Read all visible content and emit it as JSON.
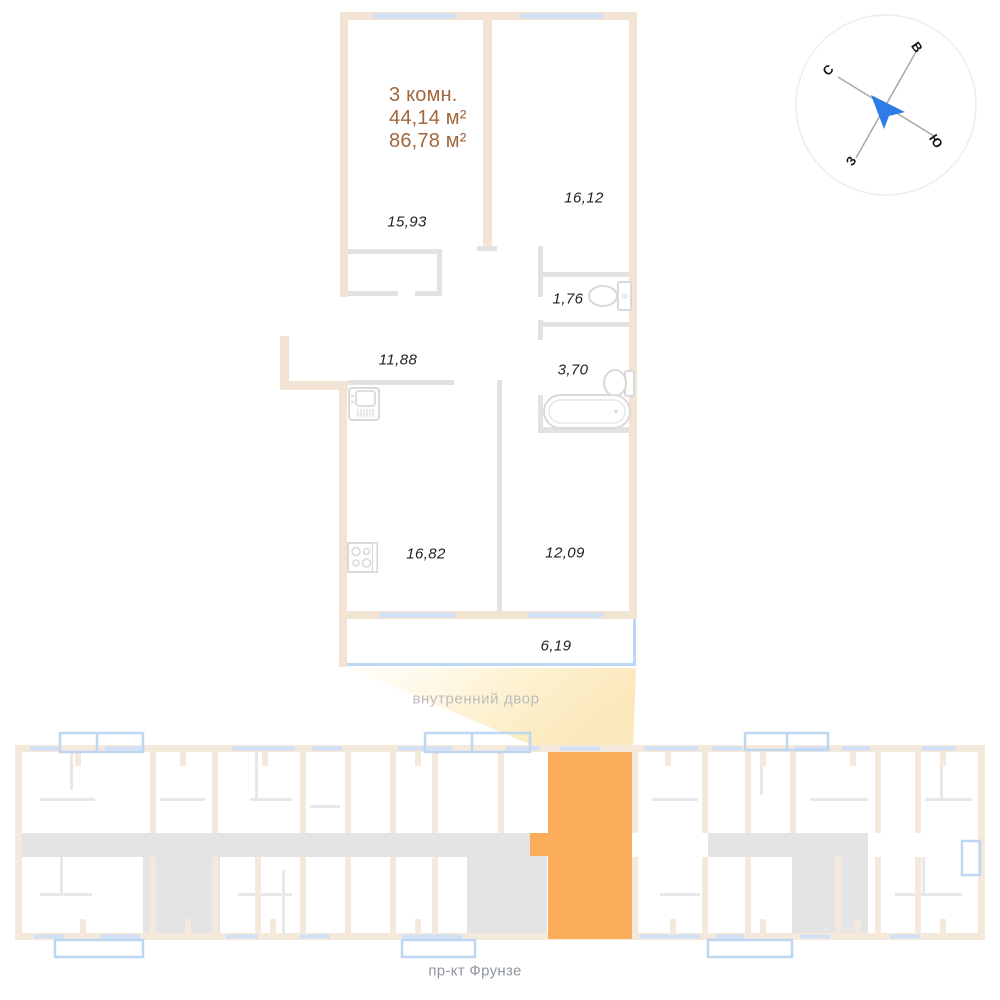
{
  "unit_card": {
    "rooms_label": "3 комн.",
    "area_living": "44,14 м²",
    "area_total": "86,78 м²",
    "accent_color": "#a2663c"
  },
  "plan": {
    "room_areas": [
      {
        "id": "living-room-1",
        "area": "15,93"
      },
      {
        "id": "living-room-2",
        "area": "16,12"
      },
      {
        "id": "wc",
        "area": "1,76"
      },
      {
        "id": "bathroom",
        "area": "3,70"
      },
      {
        "id": "hallway",
        "area": "11,88"
      },
      {
        "id": "kitchen",
        "area": "16,82"
      },
      {
        "id": "living-room-3",
        "area": "12,09"
      },
      {
        "id": "balcony",
        "area": "6,19"
      }
    ],
    "fixtures": [
      "toilet-icon",
      "sink-icon",
      "bathtub-icon",
      "kitchen-sink-icon",
      "stove-icon"
    ],
    "colors": {
      "wall": "#f2e3d4",
      "window": "#cfe0f7",
      "partition": "#e2e2e2"
    }
  },
  "compass": {
    "north": "С",
    "east": "В",
    "south": "Ю",
    "west": "З",
    "arrow_color": "#2f7ce6"
  },
  "site_plan": {
    "courtyard_label": "внутренний двор",
    "street_label": "пр-кт Фрунзе",
    "highlight_color": "#fbad5c",
    "colors": {
      "wall": "#f5e9dc",
      "balcony": "#bdd7f3",
      "core": "#e4e4e4",
      "beam": "#fbe9bc"
    }
  }
}
